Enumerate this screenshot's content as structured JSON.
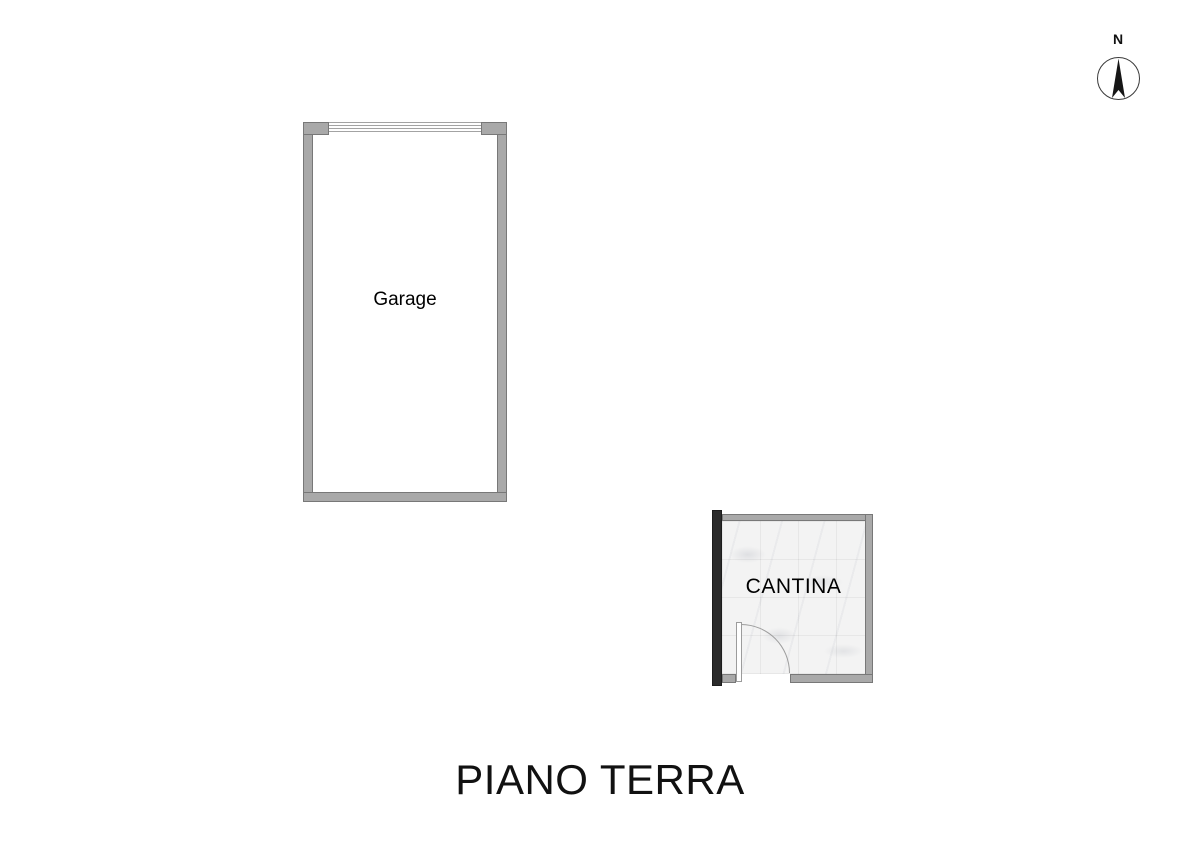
{
  "floor_plan": {
    "title": "PIANO TERRA",
    "compass": {
      "label": "N"
    },
    "rooms": [
      {
        "id": "garage",
        "label": "Garage"
      },
      {
        "id": "cantina",
        "label": "CANTINA"
      }
    ],
    "colors": {
      "background": "#ffffff",
      "wall_fill": "#a9a9a9",
      "wall_outline": "#787878",
      "dark_wall": "#2b2b2b",
      "cantina_floor": "#f3f3f3",
      "door_stroke": "#9c9c9c",
      "label_color": "#000000"
    }
  }
}
